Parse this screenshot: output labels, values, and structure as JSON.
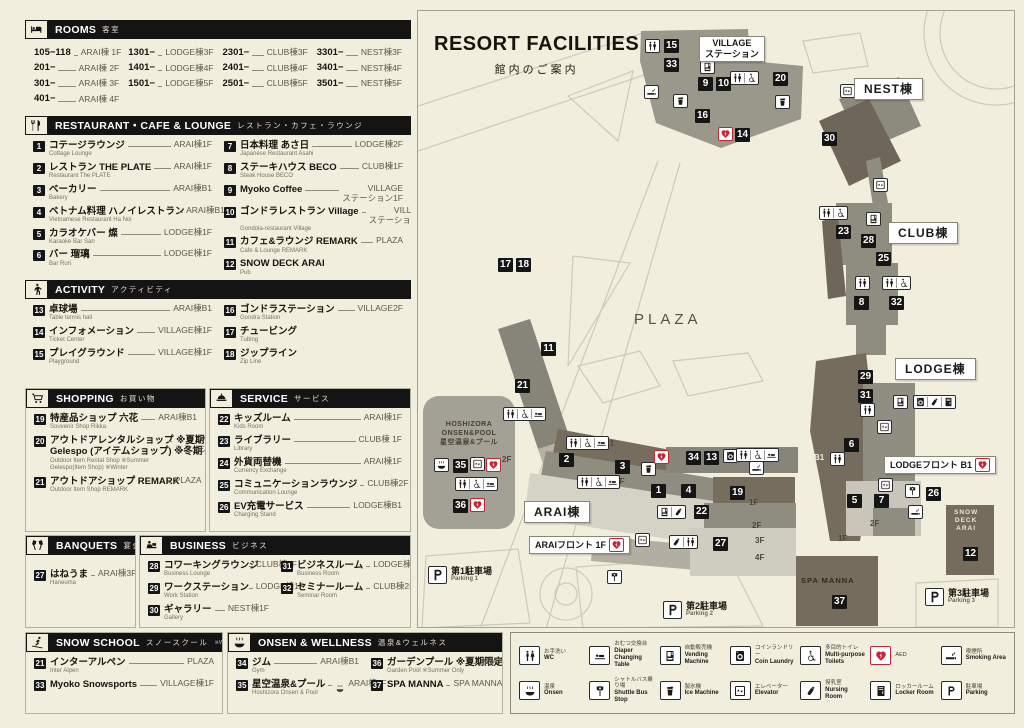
{
  "page": {
    "title": "RESORT FACILITIES",
    "subtitle": "館内のご案内"
  },
  "sections": {
    "rooms": {
      "icon": "bed",
      "title": "ROOMS",
      "ja": "客室",
      "columns": [
        [
          {
            "r": "105−118",
            "l": "ARAI棟 1F"
          },
          {
            "r": "201−",
            "l": "ARAI棟 2F"
          },
          {
            "r": "301−",
            "l": "ARAI棟 3F"
          },
          {
            "r": "401−",
            "l": "ARAI棟 4F"
          }
        ],
        [
          {
            "r": "1301−",
            "l": "LODGE棟3F"
          },
          {
            "r": "1401−",
            "l": "LODGE棟4F"
          },
          {
            "r": "1501−",
            "l": "LODGE棟5F"
          }
        ],
        [
          {
            "r": "2301−",
            "l": "CLUB棟3F"
          },
          {
            "r": "2401−",
            "l": "CLUB棟4F"
          },
          {
            "r": "2501−",
            "l": "CLUB棟5F"
          }
        ],
        [
          {
            "r": "3301−",
            "l": "NEST棟3F"
          },
          {
            "r": "3401−",
            "l": "NEST棟4F"
          },
          {
            "r": "3501−",
            "l": "NEST棟5F"
          }
        ]
      ]
    },
    "restaurant": {
      "icon": "cutlery",
      "title": "RESTAURANT・CAFE & LOUNGE",
      "ja": "レストラン・カフェ・ラウンジ",
      "split": 6,
      "items": [
        {
          "n": "1",
          "name": "コテージラウンジ",
          "en": "Cottage Lounge",
          "loc": "ARAI棟1F"
        },
        {
          "n": "2",
          "name": "レストラン THE PLATE",
          "en": "Restaurant The PLATE",
          "loc": "ARAI棟1F"
        },
        {
          "n": "3",
          "name": "ベーカリー",
          "en": "Bakery",
          "loc": "ARAI棟B1"
        },
        {
          "n": "4",
          "name": "ベトナム料理 ハノイレストラン",
          "en": "Vietnamese Restaurant  Ha Noi",
          "loc": "ARAI棟B1"
        },
        {
          "n": "5",
          "name": "カラオケバー 燦",
          "en": "Karaoke Bar San",
          "loc": "LODGE棟1F"
        },
        {
          "n": "6",
          "name": "バー 瑠璃",
          "en": "Bar Ruri",
          "loc": "LODGE棟1F"
        },
        {
          "n": "7",
          "name": "日本料理 あさ日",
          "en": "Japanese Restaurant Asahi",
          "loc": "LODGE棟2F"
        },
        {
          "n": "8",
          "name": "ステーキハウス BECO",
          "en": "Steak House BECO",
          "loc": "CLUB棟1F"
        },
        {
          "n": "9",
          "name": "Myoko Coffee",
          "en": "",
          "loc": [
            "VILLAGE",
            "ステーション1F"
          ]
        },
        {
          "n": "10",
          "name": "ゴンドラレストラン Village",
          "en": "Gondola-restaurant Village",
          "loc": [
            "VILLAGE",
            "ステーション1F"
          ]
        },
        {
          "n": "11",
          "name": "カフェ&ラウンジ REMARK",
          "en": "Cafe & Lounge REMARK",
          "loc": "PLAZA"
        },
        {
          "n": "12",
          "name": "SNOW DECK ARAI",
          "en": "Pub",
          "loc": ""
        }
      ]
    },
    "activity": {
      "icon": "walker",
      "title": "ACTIVITY",
      "ja": "アクティビティ",
      "split": 3,
      "items": [
        {
          "n": "13",
          "name": "卓球場",
          "en": "Table tennis hall",
          "loc": "ARAI棟B1"
        },
        {
          "n": "14",
          "name": "インフォメーション",
          "en": "Ticket Center",
          "loc": "VILLAGE棟1F"
        },
        {
          "n": "15",
          "name": "プレイグラウンド",
          "en": "Playground",
          "loc": "VILLAGE棟1F"
        },
        {
          "n": "16",
          "name": "ゴンドラステーション",
          "en": "Gondra Station",
          "loc": "VILLAGE2F"
        },
        {
          "n": "17",
          "name": "チュービング",
          "en": "Tubing",
          "loc": ""
        },
        {
          "n": "18",
          "name": "ジップライン",
          "en": "Zip Line",
          "loc": ""
        }
      ]
    },
    "shopping": {
      "icon": "cart",
      "title": "SHOPPING",
      "ja": "お買い物",
      "items": [
        {
          "n": "19",
          "name": "特産品ショップ 六花",
          "en": "Souvenir Shop Rikka",
          "loc": "ARAI棟B1"
        },
        {
          "n": "20",
          "name": "アウトドアレンタルショップ ※夏期",
          "name2": "Gelespo (アイテムショップ) ※冬期",
          "en": "Outdoor Item Rental Shop ※Summer",
          "en2": "Gelespo(Item Shop) ※Winter",
          "loc": [
            "VILLAGE",
            "ステーション1F"
          ]
        },
        {
          "n": "21",
          "name": "アウトドアショップ REMARK",
          "en": "Outdoor Item Shop REMARK",
          "loc": "PLAZA"
        }
      ]
    },
    "service": {
      "icon": "bell",
      "title": "SERVICE",
      "ja": "サービス",
      "items": [
        {
          "n": "22",
          "name": "キッズルーム",
          "en": "Kids Room",
          "loc": "ARAI棟1F"
        },
        {
          "n": "23",
          "name": "ライブラリー",
          "en": "Library",
          "loc": "CLUB棟 1F"
        },
        {
          "n": "24",
          "name": "外貨両替機",
          "en": "Currency Exchange",
          "loc": "ARAI棟1F"
        },
        {
          "n": "25",
          "name": "コミュニケーションラウンジ",
          "en": "Communication Lounge",
          "loc": "CLUB棟2F"
        },
        {
          "n": "26",
          "name": "EV充電サービス",
          "en": "Charging Stand",
          "loc": "LODGE棟B1"
        }
      ]
    },
    "banquets": {
      "icon": "banquet",
      "title": "BANQUETS",
      "ja": "宴会場",
      "items": [
        {
          "n": "27",
          "name": "はねうま",
          "en": "Haneuma",
          "loc": "ARAI棟3F"
        }
      ]
    },
    "business": {
      "icon": "business",
      "title": "BUSINESS",
      "ja": "ビジネス",
      "split": 3,
      "items": [
        {
          "n": "28",
          "name": "コワーキングラウンジ",
          "en": "Business Lounge",
          "loc": "CLUB棟2F"
        },
        {
          "n": "29",
          "name": "ワークステーション",
          "en": "Work Station",
          "loc": "LODGE棟1F"
        },
        {
          "n": "30",
          "name": "ギャラリー",
          "en": "Gallery",
          "loc": "NEST棟1F"
        },
        {
          "n": "31",
          "name": "ビジネスルーム",
          "en": "Business Room",
          "loc": "LODGE棟1F"
        },
        {
          "n": "32",
          "name": "セミナールーム",
          "en": "Seminar Room",
          "loc": "CLUB棟2F"
        }
      ]
    },
    "snow": {
      "icon": "ski",
      "title": "SNOW SCHOOL",
      "ja": "スノースクール",
      "note": "※Winter only",
      "items": [
        {
          "n": "21",
          "name": "インターアルペン",
          "en": "Inter Alpen",
          "loc": "PLAZA"
        },
        {
          "n": "33",
          "name": "Myoko Snowsports",
          "en": "",
          "loc": "VILLAGE棟1F"
        }
      ]
    },
    "onsen": {
      "icon": "spa",
      "title": "ONSEN & WELLNESS",
      "ja": "温泉&ウェルネス",
      "split": 2,
      "items": [
        {
          "n": "34",
          "name": "ジム",
          "en": "Gym",
          "loc": "ARAI棟B1"
        },
        {
          "n": "35",
          "name": "星空温泉&プール",
          "en": "Hoshizora Onsen & Pool",
          "locicon": "onsen",
          "loc": "ARAI棟2F"
        },
        {
          "n": "36",
          "name": "ガーデンプール ※夏期限定",
          "en": "Garden Pool ※Summer Only",
          "loc": "ARAI棟2F"
        },
        {
          "n": "37",
          "name": "SPA MANNA",
          "en": "",
          "loc": "SPA MANNA 1F"
        }
      ]
    }
  },
  "map": {
    "markers": [
      {
        "n": "15",
        "x": 246,
        "y": 28
      },
      {
        "n": "33",
        "x": 246,
        "y": 47
      },
      {
        "n": "9",
        "x": 280,
        "y": 66
      },
      {
        "n": "10",
        "x": 298,
        "y": 66
      },
      {
        "n": "20",
        "x": 355,
        "y": 61
      },
      {
        "n": "16",
        "x": 277,
        "y": 98
      },
      {
        "n": "14",
        "x": 317,
        "y": 117
      },
      {
        "n": "30",
        "x": 404,
        "y": 121
      },
      {
        "n": "23",
        "x": 418,
        "y": 214
      },
      {
        "n": "28",
        "x": 443,
        "y": 223
      },
      {
        "n": "25",
        "x": 458,
        "y": 241
      },
      {
        "n": "8",
        "x": 436,
        "y": 285
      },
      {
        "n": "32",
        "x": 471,
        "y": 285
      },
      {
        "n": "17",
        "x": 80,
        "y": 247
      },
      {
        "n": "18",
        "x": 98,
        "y": 247
      },
      {
        "n": "11",
        "x": 123,
        "y": 331
      },
      {
        "n": "21",
        "x": 97,
        "y": 368
      },
      {
        "n": "29",
        "x": 440,
        "y": 359
      },
      {
        "n": "31",
        "x": 440,
        "y": 378
      },
      {
        "n": "6",
        "x": 426,
        "y": 427
      },
      {
        "n": "5",
        "x": 429,
        "y": 483
      },
      {
        "n": "7",
        "x": 456,
        "y": 483
      },
      {
        "n": "26",
        "x": 508,
        "y": 476
      },
      {
        "n": "2",
        "x": 141,
        "y": 442
      },
      {
        "n": "3",
        "x": 197,
        "y": 449
      },
      {
        "n": "1",
        "x": 233,
        "y": 473
      },
      {
        "n": "4",
        "x": 263,
        "y": 473
      },
      {
        "n": "34",
        "x": 268,
        "y": 440
      },
      {
        "n": "13",
        "x": 286,
        "y": 440
      },
      {
        "n": "22",
        "x": 276,
        "y": 494
      },
      {
        "n": "27",
        "x": 295,
        "y": 526
      },
      {
        "n": "24",
        "x": 193,
        "y": 528
      },
      {
        "n": "35",
        "x": 35,
        "y": 448
      },
      {
        "n": "36",
        "x": 35,
        "y": 488
      },
      {
        "n": "19",
        "x": 312,
        "y": 475
      },
      {
        "n": "12",
        "x": 545,
        "y": 536
      },
      {
        "n": "37",
        "x": 414,
        "y": 584
      }
    ],
    "badges": [
      {
        "x": 227,
        "y": 28,
        "icons": [
          "wc"
        ]
      },
      {
        "x": 226,
        "y": 74,
        "icons": [
          "smoking"
        ]
      },
      {
        "x": 282,
        "y": 49,
        "icons": [
          "vending"
        ]
      },
      {
        "x": 312,
        "y": 60,
        "icons": [
          "wc",
          "wheelchair"
        ]
      },
      {
        "x": 255,
        "y": 83,
        "icons": [
          "ice"
        ]
      },
      {
        "x": 357,
        "y": 84,
        "icons": [
          "ice"
        ]
      },
      {
        "x": 300,
        "y": 116,
        "icons": [
          "aed"
        ],
        "cls": "aed"
      },
      {
        "x": 422,
        "y": 73,
        "icons": [
          "elevator"
        ]
      },
      {
        "x": 455,
        "y": 167,
        "icons": [
          "elevator"
        ]
      },
      {
        "x": 401,
        "y": 195,
        "icons": [
          "wc",
          "wheelchair"
        ]
      },
      {
        "x": 448,
        "y": 201,
        "icons": [
          "vending"
        ]
      },
      {
        "x": 437,
        "y": 265,
        "icons": [
          "wc"
        ]
      },
      {
        "x": 464,
        "y": 265,
        "icons": [
          "wc",
          "wheelchair"
        ]
      },
      {
        "x": 475,
        "y": 384,
        "icons": [
          "vending"
        ]
      },
      {
        "x": 495,
        "y": 384,
        "icons": [
          "laundry",
          "nursing",
          "locker"
        ]
      },
      {
        "x": 442,
        "y": 392,
        "icons": [
          "wc"
        ]
      },
      {
        "x": 459,
        "y": 409,
        "icons": [
          "elevator"
        ]
      },
      {
        "x": 412,
        "y": 441,
        "icons": [
          "wc"
        ]
      },
      {
        "x": 460,
        "y": 467,
        "icons": [
          "elevator"
        ]
      },
      {
        "x": 487,
        "y": 473,
        "icons": [
          "busstop"
        ]
      },
      {
        "x": 490,
        "y": 494,
        "icons": [
          "smoking"
        ]
      },
      {
        "x": 85,
        "y": 396,
        "icons": [
          "wc",
          "wheelchair",
          "diaper"
        ]
      },
      {
        "x": 16,
        "y": 447,
        "icons": [
          "onsen"
        ]
      },
      {
        "x": 52,
        "y": 446,
        "icons": [
          "elevator"
        ]
      },
      {
        "x": 68,
        "y": 447,
        "icons": [
          "aed"
        ],
        "cls": "aed"
      },
      {
        "x": 37,
        "y": 466,
        "icons": [
          "wc",
          "wheelchair",
          "diaper"
        ]
      },
      {
        "x": 52,
        "y": 487,
        "icons": [
          "aed"
        ],
        "cls": "aed"
      },
      {
        "x": 148,
        "y": 425,
        "icons": [
          "wc",
          "wheelchair",
          "diaper"
        ]
      },
      {
        "x": 159,
        "y": 464,
        "icons": [
          "wc",
          "wheelchair",
          "diaper"
        ]
      },
      {
        "x": 223,
        "y": 451,
        "icons": [
          "ice"
        ]
      },
      {
        "x": 236,
        "y": 439,
        "icons": [
          "aed"
        ],
        "cls": "aed"
      },
      {
        "x": 305,
        "y": 438,
        "icons": [
          "laundry"
        ]
      },
      {
        "x": 318,
        "y": 437,
        "icons": [
          "wc",
          "wheelchair",
          "diaper"
        ]
      },
      {
        "x": 331,
        "y": 450,
        "icons": [
          "smoking"
        ]
      },
      {
        "x": 239,
        "y": 494,
        "icons": [
          "vending",
          "nursing"
        ]
      },
      {
        "x": 217,
        "y": 522,
        "icons": [
          "elevator"
        ]
      },
      {
        "x": 251,
        "y": 524,
        "icons": [
          "nursing",
          "wc"
        ]
      },
      {
        "x": 189,
        "y": 559,
        "icons": [
          "busstop"
        ]
      }
    ],
    "labels": [
      {
        "x": 281,
        "y": 25,
        "lines": [
          "VILLAGE",
          "ステーション"
        ]
      },
      {
        "x": 436,
        "y": 67,
        "lines": [
          "NEST棟"
        ],
        "big": true
      },
      {
        "x": 470,
        "y": 211,
        "lines": [
          "CLUB棟"
        ],
        "big": true
      },
      {
        "x": 477,
        "y": 347,
        "lines": [
          "LODGE棟"
        ],
        "big": true
      },
      {
        "x": 466,
        "y": 445,
        "lines": [
          "LODGEフロント B1"
        ],
        "aed": true
      },
      {
        "x": 106,
        "y": 490,
        "lines": [
          "ARAI棟"
        ],
        "big": true
      },
      {
        "x": 111,
        "y": 525,
        "lines": [
          "ARAIフロント 1F"
        ],
        "aed": true
      }
    ],
    "texts": [
      {
        "x": 216,
        "y": 300,
        "lines": [
          "PLAZA"
        ],
        "cls": "plaza"
      },
      {
        "x": 22,
        "y": 410,
        "lines": [
          "HOSHIZORA",
          "ONSEN&POOL",
          "星空温泉&プール"
        ],
        "cls": "bldg"
      },
      {
        "x": 84,
        "y": 444,
        "lines": [
          "2F"
        ]
      },
      {
        "x": 186,
        "y": 428,
        "lines": [
          "B1"
        ]
      },
      {
        "x": 197,
        "y": 466,
        "lines": [
          "1F"
        ]
      },
      {
        "x": 396,
        "y": 442,
        "lines": [
          "B1"
        ],
        "cls": "light"
      },
      {
        "x": 452,
        "y": 508,
        "lines": [
          "2F"
        ]
      },
      {
        "x": 420,
        "y": 523,
        "lines": [
          "1F"
        ]
      },
      {
        "x": 331,
        "y": 487,
        "lines": [
          "1F"
        ]
      },
      {
        "x": 334,
        "y": 510,
        "lines": [
          "2F"
        ]
      },
      {
        "x": 337,
        "y": 525,
        "lines": [
          "3F"
        ]
      },
      {
        "x": 337,
        "y": 542,
        "lines": [
          "4F"
        ]
      },
      {
        "x": 383,
        "y": 565,
        "lines": [
          "SPA MANNA"
        ],
        "cls": "spa"
      },
      {
        "x": 536,
        "y": 498,
        "lines": [
          "SNOW",
          "DECK",
          "ARAI"
        ],
        "cls": "snowdeck"
      }
    ],
    "parkings": [
      {
        "x": 10,
        "y": 555,
        "ja": "第1駐車場",
        "en": "Parking 1"
      },
      {
        "x": 245,
        "y": 590,
        "ja": "第2駐車場",
        "en": "Parking 2"
      },
      {
        "x": 507,
        "y": 577,
        "ja": "第3駐車場",
        "en": "Parking 3"
      }
    ],
    "colors": {
      "aed_red": "#c62231",
      "marker_black": "#151515",
      "building_gray": "#8f8c80",
      "building_brown": "#756c5d",
      "cream": "#f1eedd"
    }
  },
  "legend": {
    "items": [
      {
        "icon": "wc",
        "ja": "お手洗い",
        "en": "WC"
      },
      {
        "icon": "diaper",
        "ja": "おむつ交換台",
        "en": "Diaper Changing Table"
      },
      {
        "icon": "vending",
        "ja": "自動販売機",
        "en": "Vending Machine"
      },
      {
        "icon": "laundry",
        "ja": "コインランドリー",
        "en": "Coin Laundry"
      },
      {
        "icon": "wheelchair",
        "ja": "多目的トイレ",
        "en": "Multi-purpose Toilets"
      },
      {
        "icon": "aed",
        "ja": "AED",
        "en": ""
      },
      {
        "icon": "smoking",
        "ja": "喫煙所",
        "en": "Smoking Area"
      },
      {
        "icon": "onsen",
        "ja": "温泉",
        "en": "Onsen"
      },
      {
        "icon": "busstop",
        "ja": "シャトルバス乗り場",
        "en": "Shuttle Bus Stop"
      },
      {
        "icon": "ice",
        "ja": "製氷機",
        "en": "Ice Machine"
      },
      {
        "icon": "elevator",
        "ja": "エレベーター",
        "en": "Elevator"
      },
      {
        "icon": "nursing",
        "ja": "授乳室",
        "en": "Nursing Room"
      },
      {
        "icon": "locker",
        "ja": "ロッカールーム",
        "en": "Locker Room"
      },
      {
        "icon": "parking",
        "ja": "駐車場",
        "en": "Parking"
      }
    ]
  }
}
